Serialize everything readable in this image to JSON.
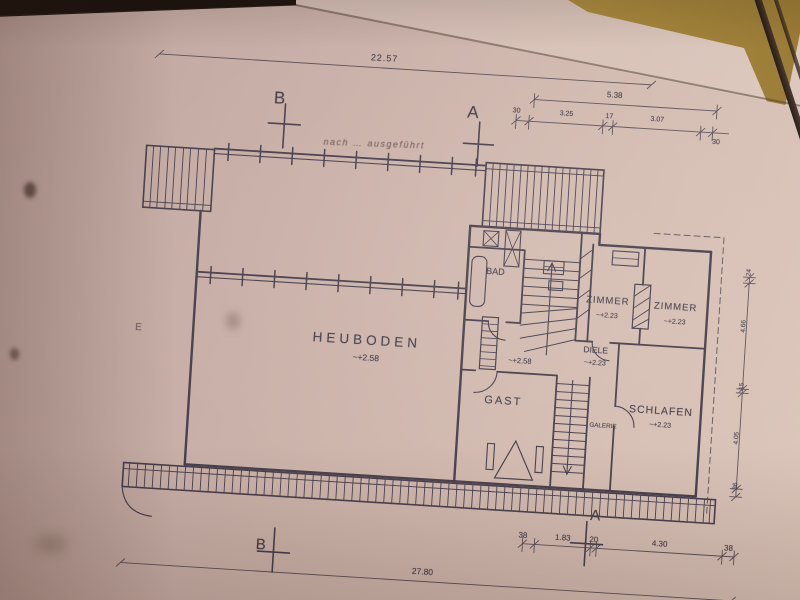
{
  "meta": {
    "description": "photographed architectural floor plan, upper storey",
    "language": "de"
  },
  "palette": {
    "paper": "#cdb5ad",
    "paper_light": "#dcc6ba",
    "ink": "#463d4b",
    "table": "#c9a94e",
    "background": "#2b211c"
  },
  "rooms": {
    "heuboden": {
      "label": "HEUBODEN",
      "level": "~+2.58"
    },
    "bad": {
      "label": "BAD"
    },
    "zimmer1": {
      "label": "ZIMMER",
      "level": "~+2.23"
    },
    "zimmer2": {
      "label": "ZIMMER",
      "level": "~+2.23"
    },
    "diele": {
      "label": "DIELE",
      "level": "~+2.23"
    },
    "schlafen": {
      "label": "SCHLAFEN",
      "level": "~+2.23"
    },
    "gast": {
      "label": "GAST"
    },
    "galerie": {
      "label": "GALERIE"
    },
    "stair_level": "~+2.58"
  },
  "dimensions": {
    "top_total": "22.57",
    "top_right": {
      "total": "5.38",
      "segments": [
        "30",
        "3.25",
        "17",
        "3.07",
        "30"
      ]
    },
    "bottom_right": {
      "segments": [
        "38",
        "1.83",
        "20",
        "4.30",
        "38"
      ]
    },
    "bottom_total": "27.80",
    "right_side": {
      "segments": [
        "24",
        "4.66",
        "15",
        "4.05",
        "36"
      ]
    }
  },
  "section_markers": {
    "top_b": "B",
    "top_a": "A",
    "bottom_b": "B",
    "bottom_a": "A"
  },
  "handwriting": {
    "note": "nach … ausgeführt"
  },
  "paper_marks": {
    "pencil_letter": "E"
  }
}
